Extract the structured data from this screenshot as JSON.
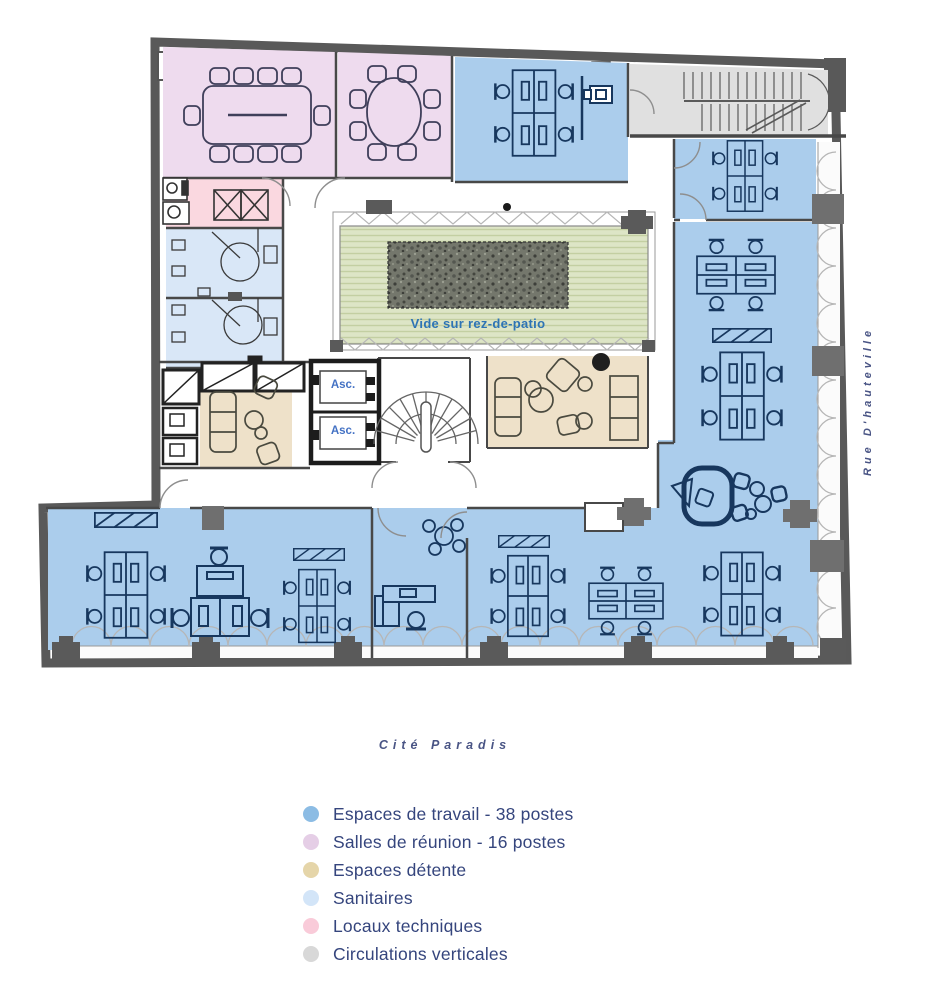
{
  "plan": {
    "patio_label": "Vide sur rez-de-patio",
    "elevator_label": "Asc."
  },
  "streets": {
    "right": "Rue D'hauteville",
    "bottom": "Cité Paradis"
  },
  "zone_colors": {
    "work": "#abcdec",
    "meeting": "#eedbee",
    "lounge": "#eee1c9",
    "sanitary": "#d9e7f7",
    "technical": "#fad8e0",
    "circulation": "#e0e0e0",
    "patio": "#dde5c6"
  },
  "legend": {
    "text_color": "#35457d",
    "items": [
      {
        "key": "work",
        "label": "Espaces de travail - 38 postes",
        "color": "#8cbce4"
      },
      {
        "key": "meeting",
        "label": "Salles de réunion - 16 postes",
        "color": "#e5cee6"
      },
      {
        "key": "lounge",
        "label": "Espaces détente",
        "color": "#e5d5a9"
      },
      {
        "key": "sanitary",
        "label": "Sanitaires",
        "color": "#d3e5f8"
      },
      {
        "key": "technical",
        "label": "Locaux techniques",
        "color": "#f9cbd9"
      },
      {
        "key": "circulation",
        "label": "Circulations verticales",
        "color": "#d8d8d8"
      }
    ]
  }
}
